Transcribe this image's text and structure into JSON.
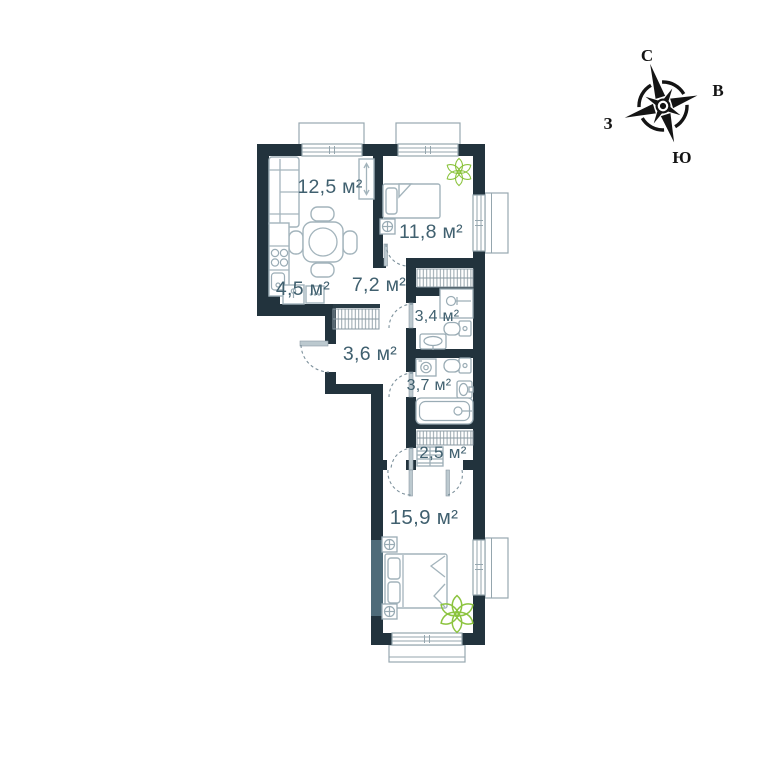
{
  "plan": {
    "rooms": [
      {
        "id": "living-room",
        "area_label": "12,5 м²"
      },
      {
        "id": "bedroom-1",
        "area_label": "11,8 м²"
      },
      {
        "id": "kitchen",
        "area_label": "4,5 м²"
      },
      {
        "id": "hallway",
        "area_label": "7,2 м²"
      },
      {
        "id": "bathroom-small",
        "area_label": "3,4 м²"
      },
      {
        "id": "hall",
        "area_label": "3,6 м²"
      },
      {
        "id": "bathroom-large",
        "area_label": "3,7 м²"
      },
      {
        "id": "closet",
        "area_label": "2,5 м²"
      },
      {
        "id": "bedroom-2",
        "area_label": "15,9 м²"
      }
    ],
    "compass": {
      "north": "С",
      "east": "В",
      "south": "Ю",
      "west": "З"
    },
    "colors": {
      "wall": "#22333d",
      "label_text": "#40606f",
      "furniture_line": "#a3b4bc",
      "window_line": "#95a6ae",
      "plant_green": "#8cc43f",
      "compass_black": "#141414"
    }
  }
}
